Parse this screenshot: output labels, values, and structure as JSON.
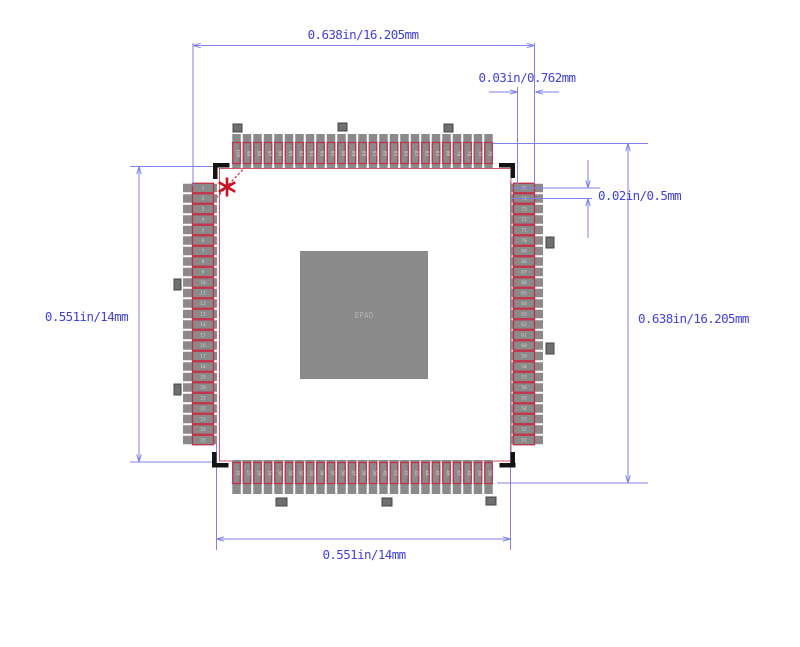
{
  "drawing": {
    "type": "ic-footprint-land-pattern",
    "package": {
      "total_pins": 100,
      "pins_per_side": 25,
      "style": "QFP"
    },
    "labels": {
      "dim_top": "0.638in/16.205mm",
      "dim_pad_length": "0.03in/0.762mm",
      "dim_pitch": "0.02in/0.5mm",
      "dim_right": "0.638in/16.205mm",
      "dim_left": "0.551in/14mm",
      "dim_bottom": "0.551in/14mm",
      "center_pad": "EPAD"
    },
    "pins": {
      "left": {
        "start": 1,
        "end": 25,
        "direction": "top-to-bottom"
      },
      "bottom": {
        "start": 26,
        "end": 50,
        "direction": "left-to-right"
      },
      "right": {
        "start": 51,
        "end": 75,
        "direction": "bottom-to-top"
      },
      "top": {
        "start": 76,
        "end": 100,
        "direction": "right-to-left"
      }
    },
    "colors": {
      "dimension_line": "#8282ea",
      "dimension_text": "#4141dc",
      "pad_fill": "#8a8a8a",
      "pad_outline": "#c2304a",
      "body_outline": "#d4556a",
      "pin1_marker": "#cc1122",
      "chamfer_line": "#cc2233",
      "corner_bracket": "#141414",
      "marker_fill": "#6f6f6f",
      "marker_stroke": "#454545",
      "epad_fill": "#8a8a8a",
      "epad_text": "#b3b3b3",
      "pin_number_text": "#cfcfcf"
    }
  }
}
